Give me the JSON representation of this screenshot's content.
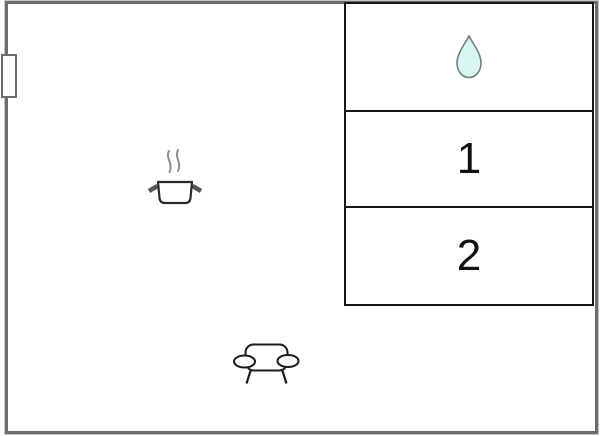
{
  "floor_plan": {
    "canvas": {
      "width": 600,
      "height": 436,
      "background": "#ffffff"
    },
    "wall_color": "#6c6c6c",
    "room_line_color": "#161616",
    "rooms": [
      {
        "name": "bathroom",
        "label": "",
        "icon": "water-drop-icon"
      },
      {
        "name": "bedroom-1",
        "label": "1",
        "icon": ""
      },
      {
        "name": "bedroom-2",
        "label": "2",
        "icon": ""
      }
    ],
    "icons": {
      "water_drop": {
        "name": "water-drop-icon",
        "fill": "#d9f7f0",
        "stroke": "#70807c"
      },
      "stove": {
        "name": "cooking-pot-steam-icon",
        "stroke": "#2b2b2b",
        "steam": "#8e8e8e",
        "handle": "#565656"
      },
      "sofa": {
        "name": "sofa-icon",
        "stroke": "#1a1a1a"
      },
      "door": {
        "name": "door-marker",
        "border": "#6c6c6c"
      }
    }
  }
}
